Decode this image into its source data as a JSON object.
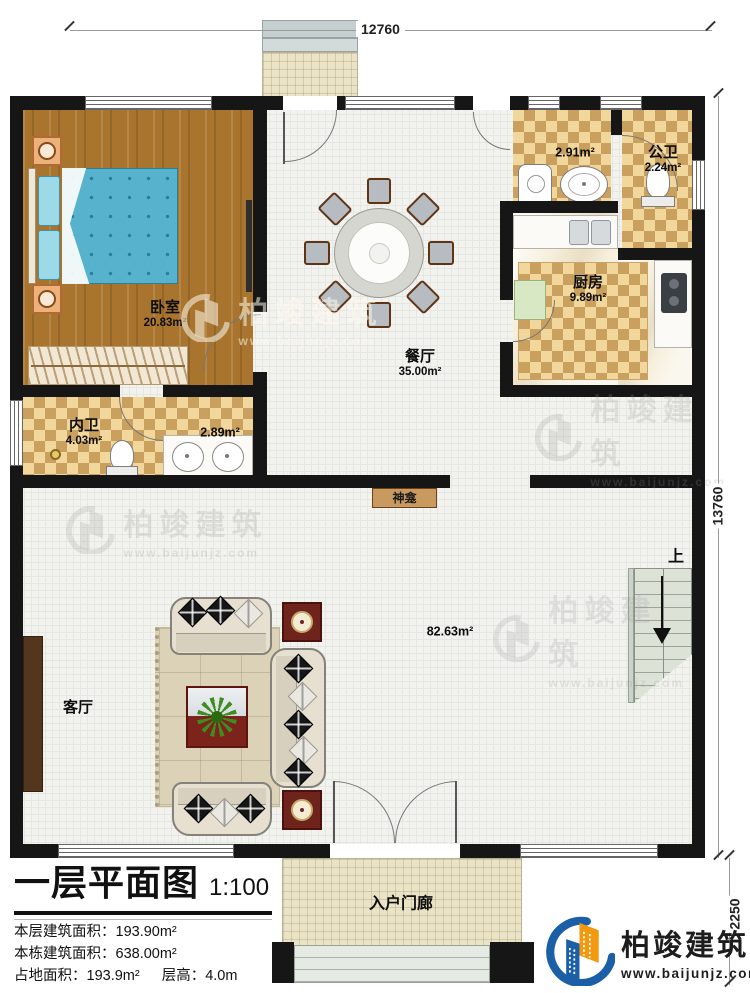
{
  "plan": {
    "dimensions": {
      "top_width": "12760",
      "right_height": "13760",
      "porch_depth": "2250"
    },
    "rooms": {
      "bedroom": {
        "name": "卧室",
        "area": "20.83m²"
      },
      "dining_room": {
        "name": "餐厅",
        "area": "35.00m²"
      },
      "kitchen": {
        "name": "厨房",
        "area": "9.89m²"
      },
      "public_bathroom": {
        "name": "公卫",
        "area": "2.24m²"
      },
      "laundry_nook": {
        "area": "2.91m²"
      },
      "private_bathroom": {
        "name": "内卫",
        "area": "4.03m²"
      },
      "vanity_nook": {
        "area": "2.89m²"
      },
      "great_hall": {
        "area": "82.63m²"
      },
      "living_room": {
        "name": "客厅"
      },
      "shrine": {
        "name": "神龛"
      },
      "entry_porch": {
        "name": "入户门廊"
      },
      "stairs": {
        "direction_label": "上"
      }
    }
  },
  "title_block": {
    "title": "一层平面图",
    "scale": "1:100",
    "line1_label": "本层建筑面积：",
    "line1_value": "193.90m²",
    "line2_label": "本栋建筑面积：",
    "line2_value": "638.00m²",
    "line3_label": "占地面积：",
    "line3_value": "193.9m²",
    "line4_label": "层高：",
    "line4_value": "4.0m"
  },
  "branding": {
    "company": "柏竣建筑",
    "website": "www.baijunjz.com"
  },
  "watermark": {
    "company": "柏竣建筑",
    "website": "www.baijunjz.com"
  },
  "colors": {
    "wall": "#161616",
    "wood_floor": "#a9752e",
    "checker_dark": "#caa05f",
    "checker_light": "#f2d79c",
    "logo_blue": "#1b5fa6",
    "logo_orange": "#f2990f"
  }
}
